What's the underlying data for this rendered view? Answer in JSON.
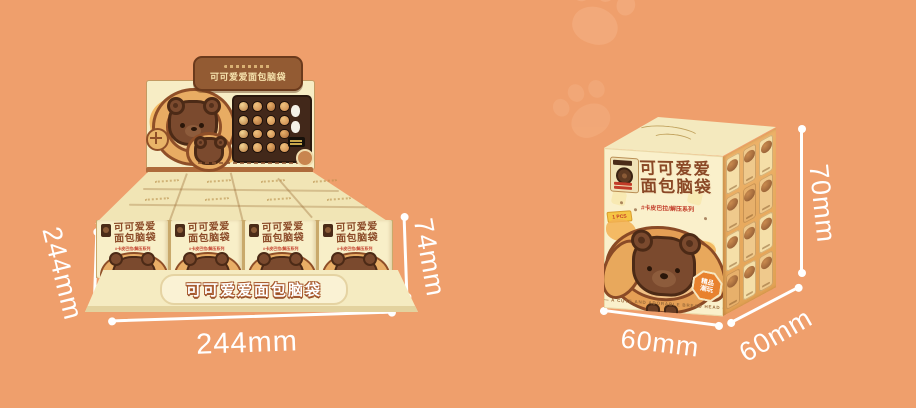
{
  "colors": {
    "background": "#EF9F6C",
    "box_cream": "#FAF0CB",
    "title_brown": "#8A4826",
    "accent_red": "#C23B28",
    "dimension_text": "#FFFFFF"
  },
  "product": {
    "series_name": "可可爱爱面包脑袋",
    "title_line1": "可可爱爱",
    "title_line2": "面包脑袋",
    "subtitle": "#卡皮巴拉/解压系列",
    "pcs_badge": "1 PCS",
    "corner_badge_line1": "精品",
    "corner_badge_line2": "潮玩",
    "footer_text": "— A CUTE AND ADORABLE BREAD HEAD —"
  },
  "display_box": {
    "header_banner_text": "可可爱爱面包脑袋",
    "front_banner_text": "可可爱爱面包脑袋",
    "dim_depth": "244mm",
    "dim_width": "244mm",
    "dim_height": "74mm"
  },
  "single_box": {
    "dim_width": "60mm",
    "dim_depth": "60mm",
    "dim_height": "70mm"
  }
}
